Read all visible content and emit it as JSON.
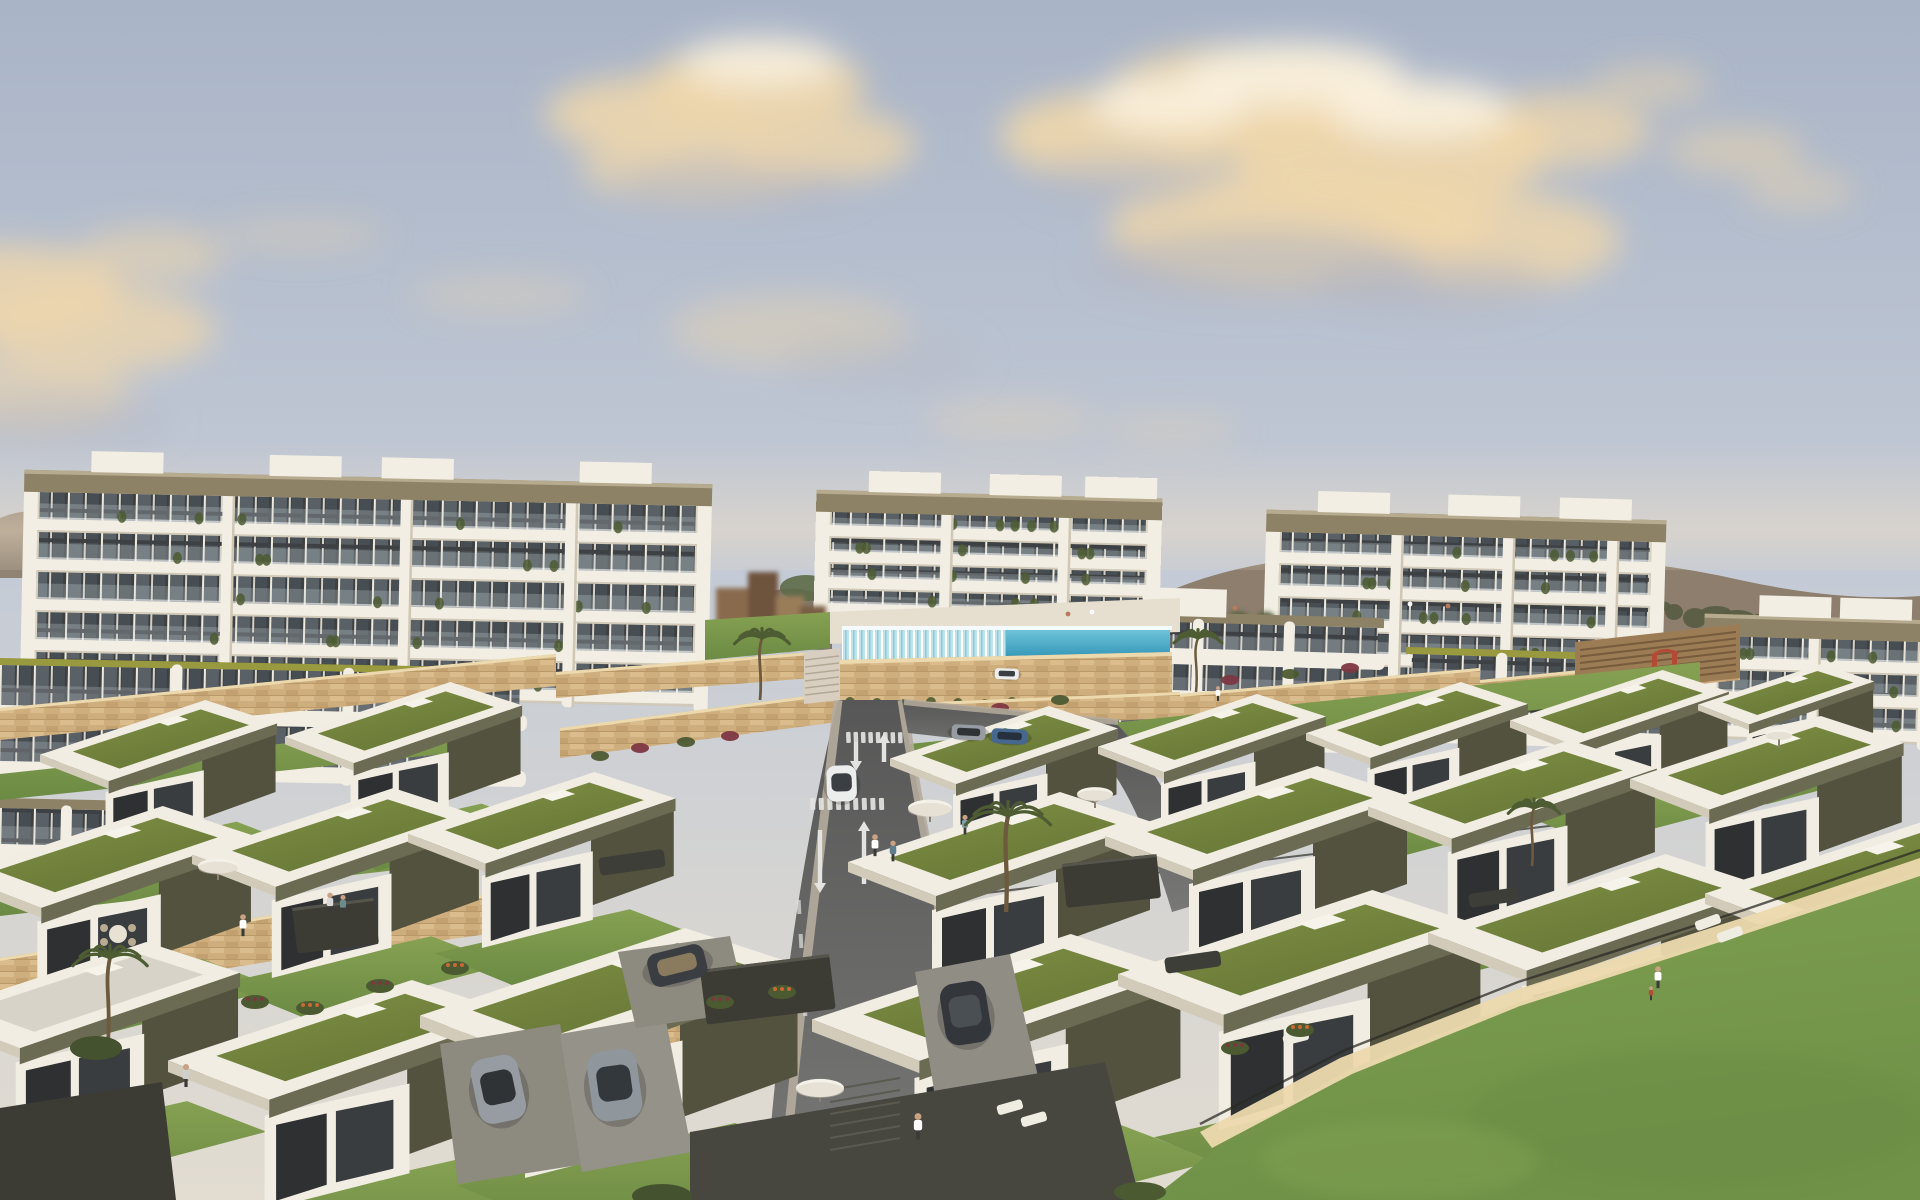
{
  "scene": {
    "title": "Aerial golden-hour rendering of a modern coastal residential development",
    "description": "Architectural visualization at golden hour: white multi-storey apartment blocks with banded balconies along the skyline, an infinity pool with a glass waterfall edge, terraced rows of flat-roofed villas with green sedum roofs and olive-grey fascias, sandstone retaining walls with flowering planters, a curving two-lane access road with painted arrows and crosswalks, palm trees, parked cars, scattered residents and a broad lawn in the foreground under a hazy blue sky with warm sunlit clouds.",
    "environment": {
      "time_of_day": "golden hour",
      "sky": "hazy blue with warm cream clouds",
      "backdrop": "low mauve mountain ridge with tree cover"
    },
    "palette": {
      "sky_top": "#a9b4c7",
      "sky_mid": "#c3cad6",
      "sky_horizon": "#e2dcd1",
      "haze": "#ecdcc4",
      "cloud_warm": "#f0d7ab",
      "cloud_bright": "#faf1de",
      "cloud_grey": "#b4b6c0",
      "mountain": "#8d7e6e",
      "ridge_trees": "#575c41",
      "facade_white": "#f2eee4",
      "facade_shadow": "#d9d2c1",
      "fascia_taupe": "#8e8266",
      "glass_dark": "#3e4144",
      "glass_lit": "#596167",
      "balcony_glass": "#c7d0d3",
      "olive_roof_stripe": "#99993f",
      "stone_light": "#ecd9ae",
      "stone_mid": "#cfae7e",
      "stone_dark": "#a3814f",
      "roof_grass_1": "#7f9045",
      "roof_grass_2": "#677736",
      "lawn_light": "#86a152",
      "lawn_dark": "#6b8a43",
      "villa_white": "#f1ede2",
      "villa_dark_wall": "#53523f",
      "villa_fascia": "#6b6a52",
      "glazing_dark": "#2e3032",
      "road_asphalt": "#656565",
      "road_marking": "#e3e3e1",
      "sidewalk": "#b5ac9c",
      "pool_shallow": "#bfe3ea",
      "pool_deep": "#2f93b6",
      "car_white": "#eceeee",
      "car_grey": "#969ca1",
      "car_blue": "#47688e",
      "car_dark": "#33373b",
      "skin": "#c9a183",
      "accent_red": "#b44a35",
      "planter_orange": "#c86a35",
      "bush_crimson": "#7d3742",
      "hedge_green": "#4c5a31"
    },
    "elements": {
      "apartment_blocks": 4,
      "garden_apartment_tiers": 4,
      "terraced_villas": 19,
      "infinity_pool": 1,
      "waterfall_edge": 1,
      "road_lanes": 2,
      "crosswalks": 2,
      "road_arrows": 4,
      "cars": 8,
      "palm_trees": 5,
      "people": 11,
      "sun_umbrellas": 5,
      "sun_loungers": 6,
      "playground": 1,
      "stone_retaining_walls": true,
      "foreground_lawn": true
    }
  }
}
